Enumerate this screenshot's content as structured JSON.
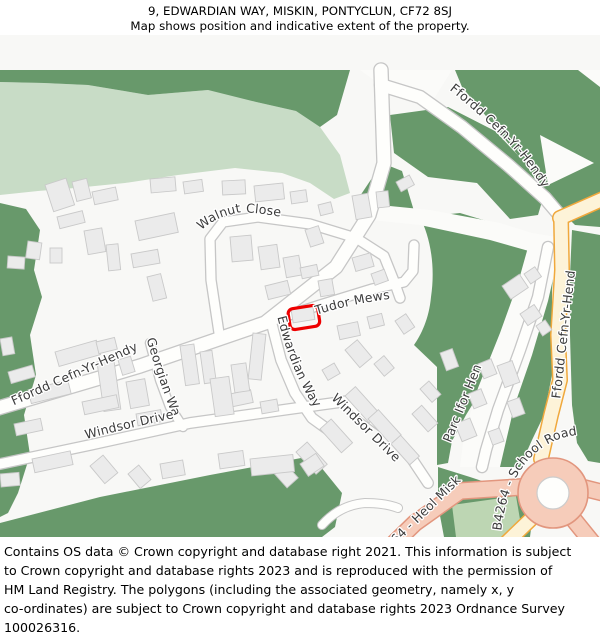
{
  "header": {
    "line1": "9, EDWARDIAN WAY, MISKIN, PONTYCLUN, CF72 8SJ",
    "line2": "Map shows position and indicative extent of the property."
  },
  "map": {
    "streets": {
      "walnut_close": "Walnut Close",
      "tudor_mews": "Tudor Mews",
      "edwardian_way": "Edwardian Way",
      "ffordd_left": "Ffordd Cefn-Yr-Hendy",
      "ffordd_top": "Ffordd Cefn-Yr-Hendy",
      "ffordd_right": "Ffordd Cefn-Yr-Hendy",
      "georgian_way": "Georgian Way",
      "windsor_drive_w": "Windsor Drive",
      "windsor_drive_e": "Windsor Drive",
      "parc_ifor_hen": "Parc Ifor Hen",
      "b4264_school": "B4264 - School Road",
      "b4264_heol": "B4264 - Heol Miskin"
    },
    "colors": {
      "green_dark": "#68996b",
      "green_light": "#c8dcc6",
      "field": "#bdd6b3",
      "road_b_fill": "#fdf3d8",
      "road_b_edge": "#f0a83c",
      "road_a_fill": "#f6ccba",
      "road_a_edge": "#e2967e",
      "building": "#ebebeb",
      "building_edge": "#c9c9c9",
      "road_edge": "#c6c6c6",
      "property_outline": "#ee0000"
    }
  },
  "footer": {
    "lines": [
      "Contains OS data © Crown copyright and database right 2021. This information is subject",
      "to Crown copyright and database rights 2023 and is reproduced with the permission of",
      "HM Land Registry. The polygons (including the associated geometry, namely x, y",
      "co-ordinates) are subject to Crown copyright and database rights 2023 Ordnance Survey",
      "100026316."
    ]
  }
}
